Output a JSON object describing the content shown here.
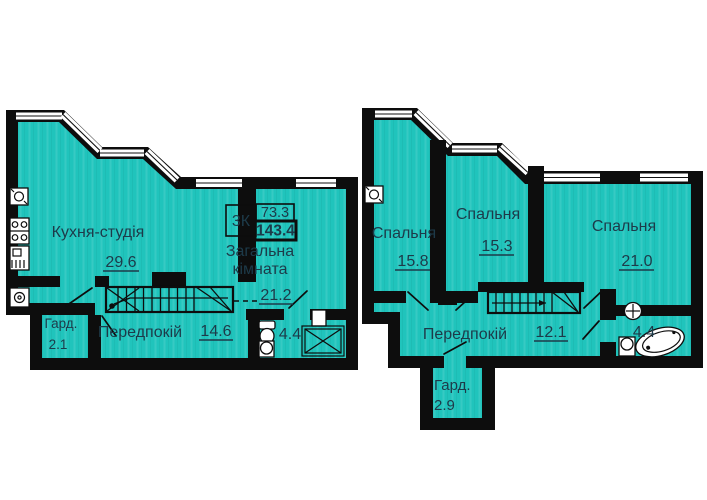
{
  "plans": {
    "lower": {
      "info": {
        "rooms_label": "3К",
        "upper_area": "73.3",
        "total_area": "143.4"
      },
      "kitchen": {
        "name": "Кухня-студія",
        "area": "29.6"
      },
      "living": {
        "line1": "Загальна",
        "line2": "кімната",
        "area": "21.2"
      },
      "hall": {
        "name": "Передпокій",
        "area": "14.6"
      },
      "wardrobe": {
        "name": "Гард.",
        "area": "2.1"
      },
      "bath": {
        "area": "4.4"
      }
    },
    "upper": {
      "bedroom1": {
        "name": "Спальня",
        "area": "15.8"
      },
      "bedroom2": {
        "name": "Спальня",
        "area": "15.3"
      },
      "bedroom3": {
        "name": "Спальня",
        "area": "21.0"
      },
      "hall": {
        "name": "Передпокій",
        "area": "12.1"
      },
      "wardrobe": {
        "name": "Гард.",
        "area": "2.9"
      },
      "bath": {
        "area": "4.4"
      }
    }
  },
  "colors": {
    "room_fill": "#20c4bc",
    "wall": "#0d0d0d",
    "text": "#1d3a49",
    "background": "#ffffff"
  }
}
